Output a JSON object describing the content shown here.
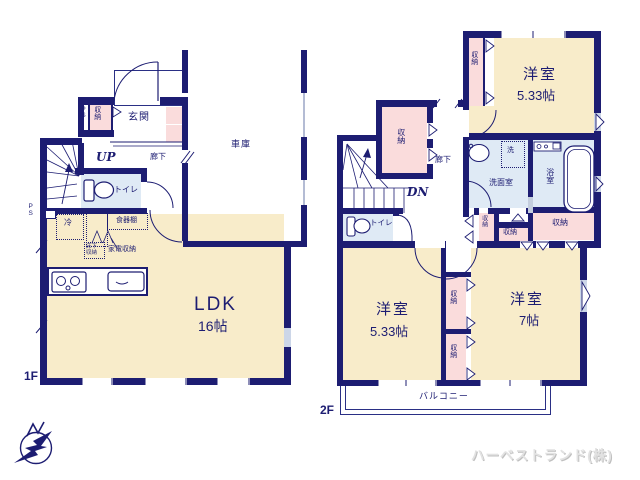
{
  "floor1": {
    "floor_tag": "1F",
    "ldk": "LDK",
    "ldk_size": "16帖",
    "genkan": "玄関",
    "garage": "車庫",
    "toilet": "トイレ",
    "hallway": "廊下",
    "stairs": "UP",
    "closet": "収納",
    "ps": "PS",
    "ps_shaft": "PS",
    "fridge": "冷",
    "cupboard": "食器棚",
    "appliance_storage": "家電収納",
    "underfloor_storage": "床下収納"
  },
  "floor2": {
    "floor_tag": "2F",
    "room1": "洋室",
    "room1_size": "5.33帖",
    "room2": "洋室",
    "room2_size": "7帖",
    "room3": "洋室",
    "room3_size": "5.33帖",
    "bath": "浴室",
    "washroom": "洗面室",
    "washer": "洗",
    "toilet": "トイレ",
    "hallway": "廊下",
    "stairs": "DN",
    "balcony": "バルコニー",
    "closet_top": "収納",
    "closet_mid": "収納",
    "closet_bath": "収納",
    "closet_a": "収納",
    "closet_b": "収納",
    "closet_1": "収納",
    "closet_2": "収納"
  },
  "footer": {
    "company": "ハーベストランド(株)"
  },
  "colors": {
    "wall": "#1d1d72",
    "room_cream": "#f8ecca",
    "closet_pink": "#fadcdc",
    "wet_blue": "#dfeaf5",
    "glazing": "#ccd6e8",
    "label": "#1d1d72",
    "company_gray": "#e2e2e2"
  }
}
